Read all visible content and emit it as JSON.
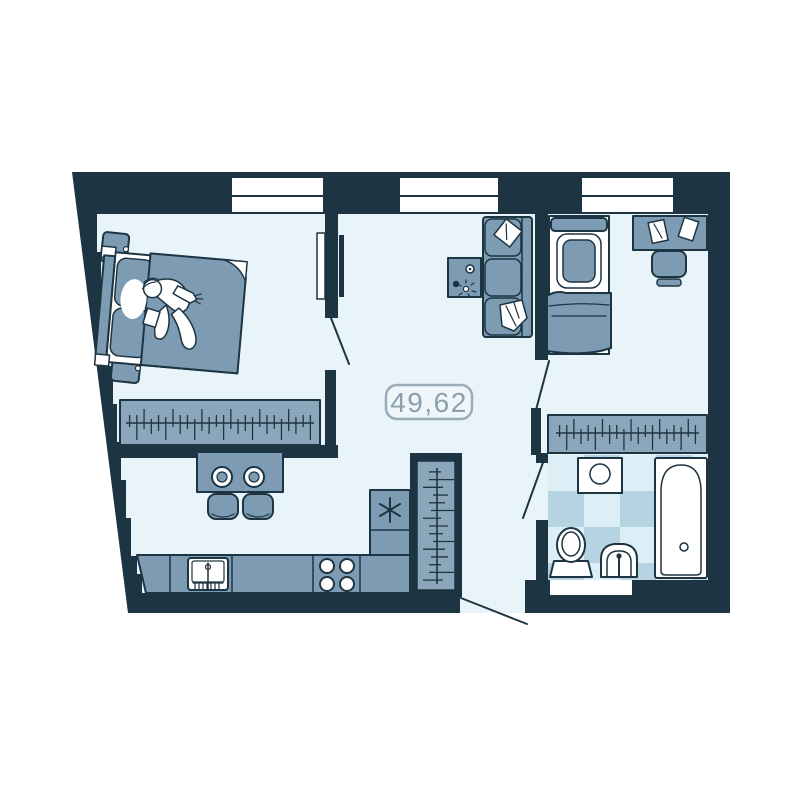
{
  "plan": {
    "area_label": "49,62"
  },
  "windows": {
    "count": 3
  },
  "colors": {
    "wall": "#1d3442",
    "floor": "#e8f4f9",
    "furniture": "#7d9cb3",
    "furniturelight": "#8ba6ba",
    "checkerlight": "#dceff6",
    "checkerdark": "#b6d3e1",
    "white": "#ffffff",
    "labelborder": "#9aacb9",
    "labeltext": "#8c9fad",
    "labelfill": "#eef6fa"
  },
  "furniture_icons": [
    "double-bed-icon",
    "sleeping-person-icon",
    "nightstand-icon",
    "wardrobe-hangers-icon",
    "bar-table-icon",
    "bar-stool-icon",
    "kitchen-sink-icon",
    "stove-icon",
    "fridge-snowflake-icon",
    "sofa-icon",
    "coffee-table-icon",
    "single-bed-icon",
    "desk-icon",
    "desk-chair-icon",
    "washing-machine-icon",
    "toilet-icon",
    "wash-basin-icon",
    "bathtub-icon",
    "door-swing-icon",
    "window-icon"
  ]
}
